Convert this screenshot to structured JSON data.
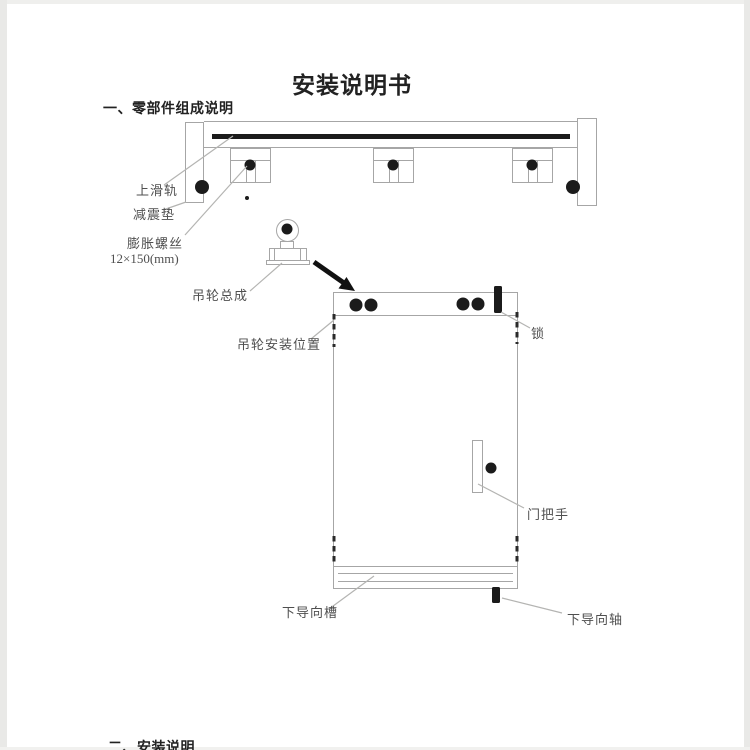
{
  "page": {
    "title": "安装说明书",
    "section1_heading": "一、零部件组成说明",
    "section2_heading": "二、安装说明"
  },
  "diagram_labels": {
    "upper_rail": "上滑轨",
    "shock_pad": "减震垫",
    "expansion_screw": "膨胀螺丝",
    "expansion_screw_size": "12×150(mm)",
    "hanger_wheel_assembly": "吊轮总成",
    "hanger_wheel_install_position": "吊轮安装位置",
    "lock": "锁",
    "door_handle": "门把手",
    "lower_guide_groove": "下导向槽",
    "lower_guide_shaft": "下导向轴"
  },
  "colors": {
    "paper": "#ffffff",
    "edge_shade": "#e9e9e7",
    "ink_black": "#1b1b1b",
    "line_gray": "#a6a6a6",
    "leader_gray": "#b4b4b2",
    "label_text": "#4f4f4f",
    "heading_text": "#222222"
  }
}
